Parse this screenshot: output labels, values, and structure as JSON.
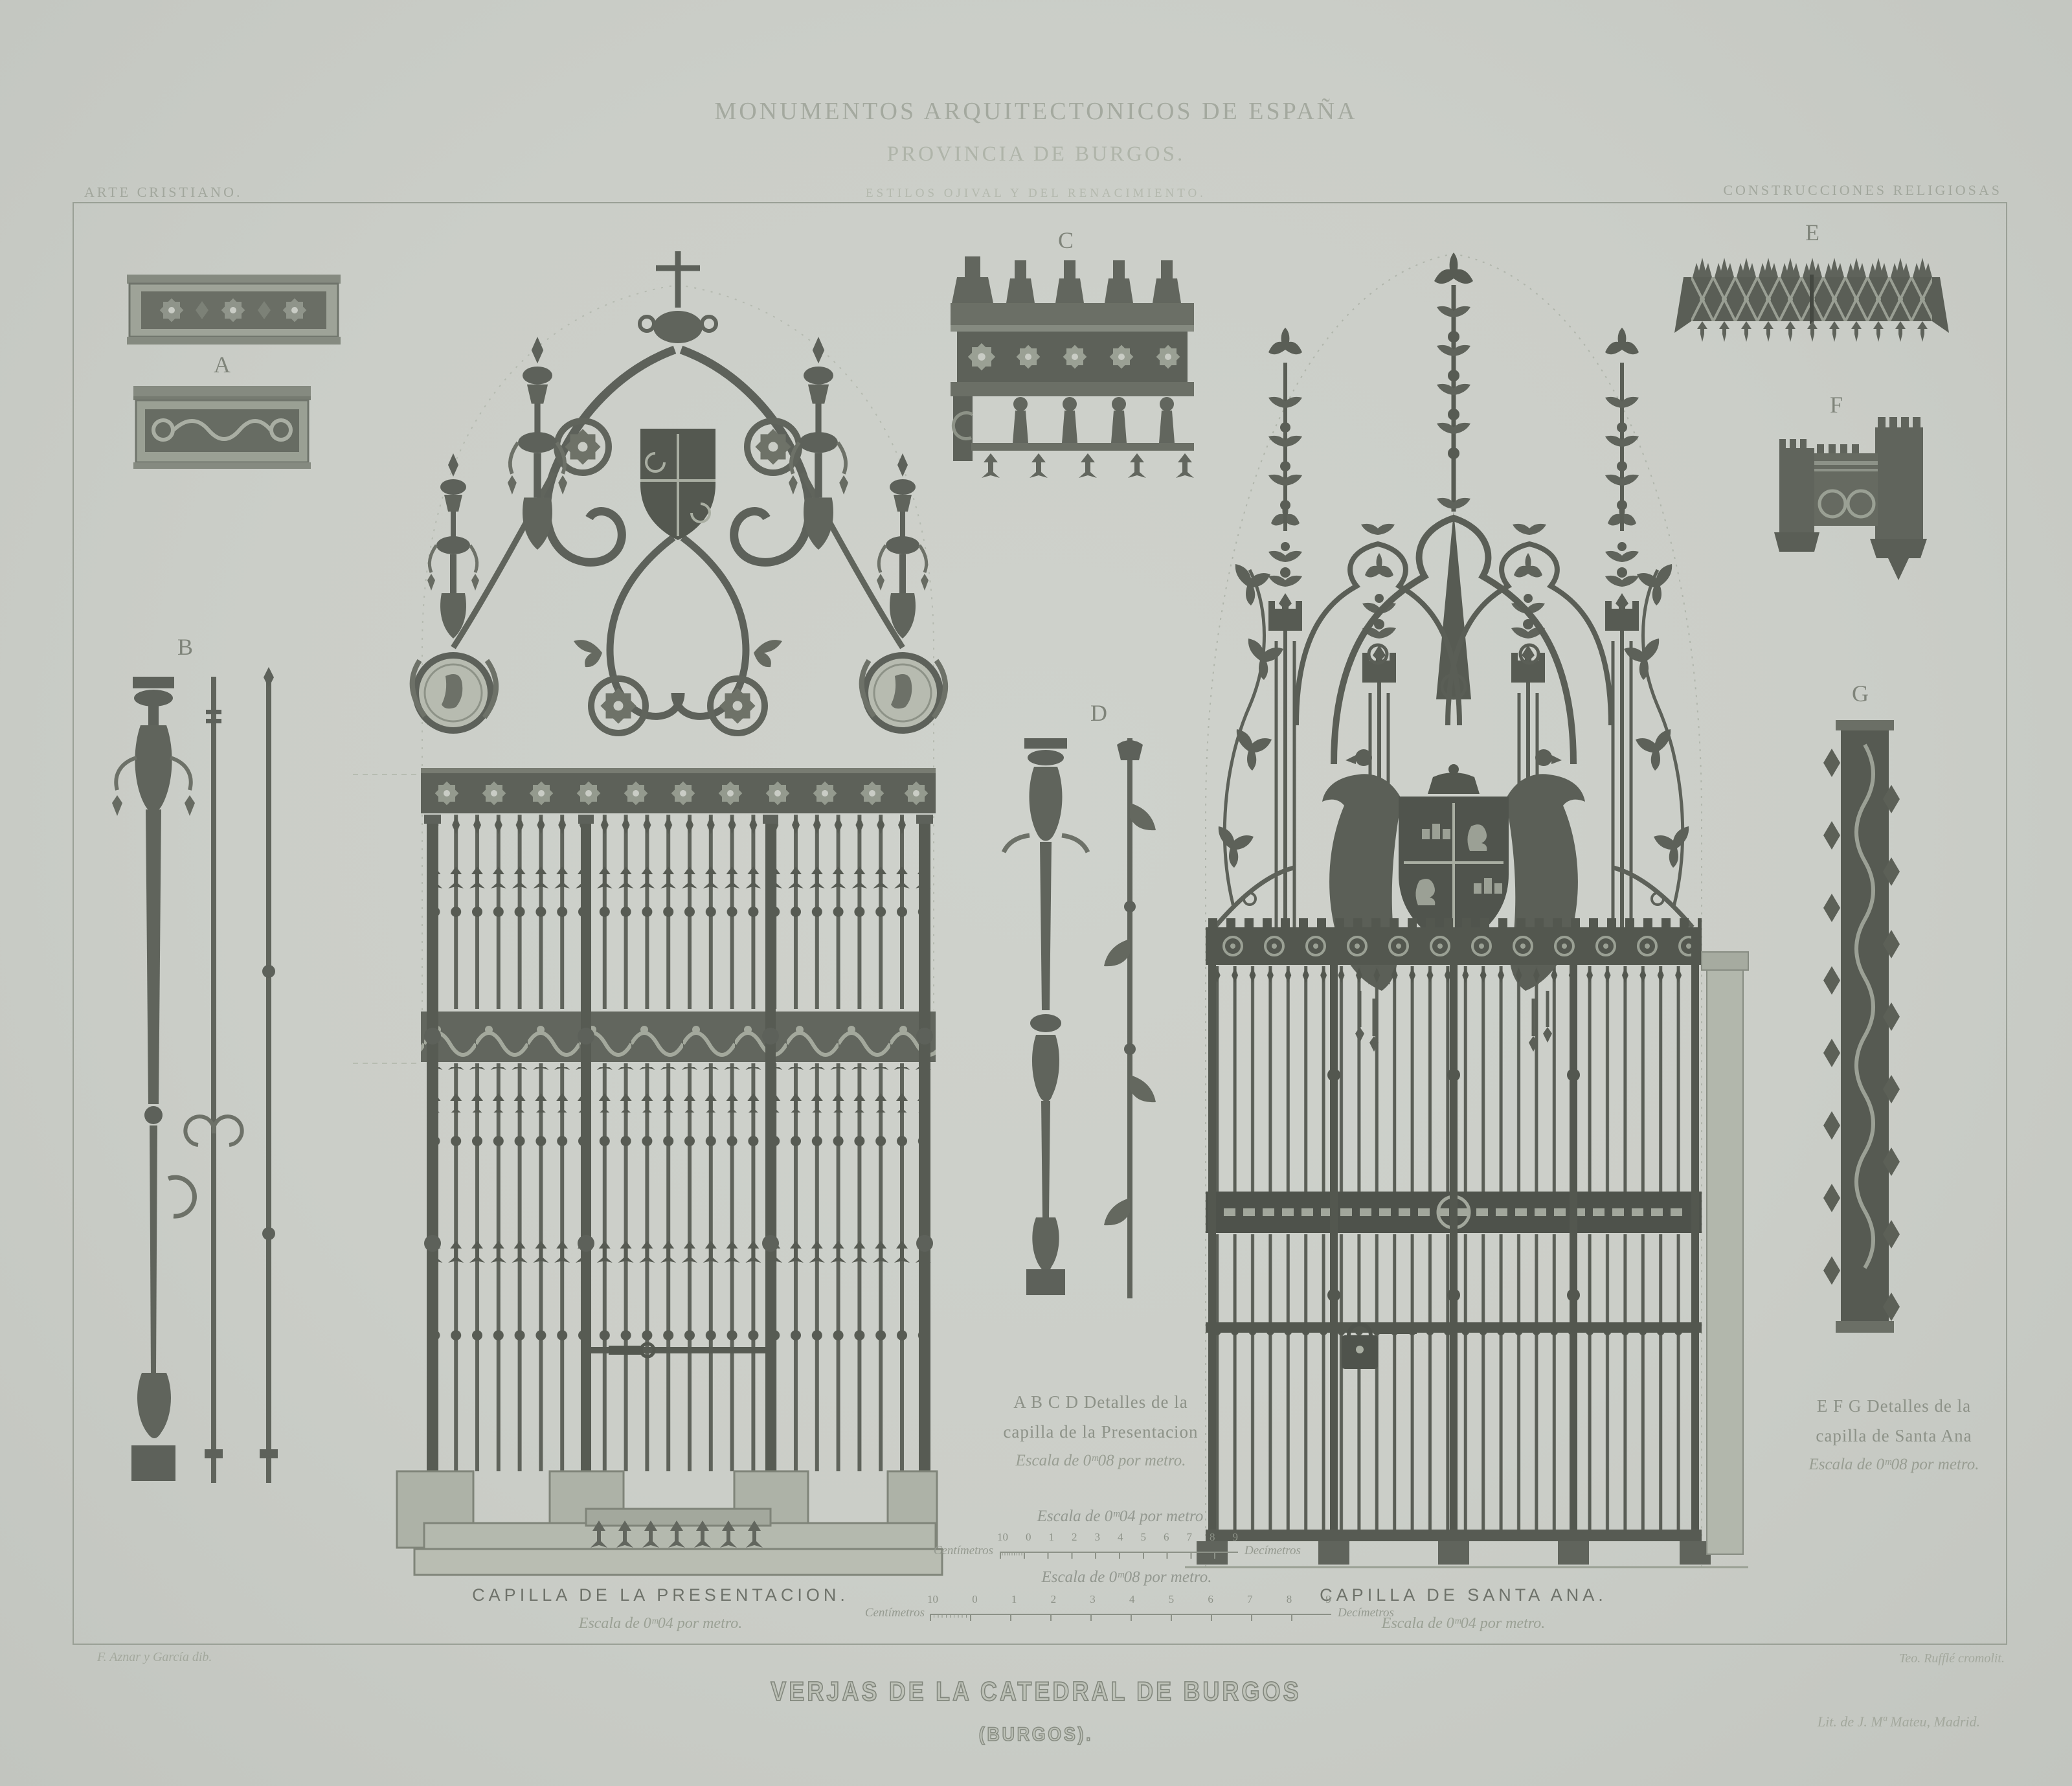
{
  "header": {
    "series_title": "MONUMENTOS ARQUITECTONICOS DE ESPAÑA",
    "province": "PROVINCIA DE BURGOS.",
    "styles_line": "ESTILOS OJIVAL Y DEL RENACIMIENTO.",
    "left_category": "ARTE CRISTIANO.",
    "right_category": "CONSTRUCCIONES RELIGIOSAS"
  },
  "figure_letters": {
    "a": "A",
    "b": "B",
    "c": "C",
    "d": "D",
    "e": "E",
    "f": "F",
    "g": "G"
  },
  "left_gate": {
    "caption": "CAPILLA DE LA PRESENTACION.",
    "scale_note": "Escala de 0ᵐ04 por metro."
  },
  "right_gate": {
    "caption": "CAPILLA DE SANTA ANA.",
    "scale_note": "Escala de 0ᵐ04 por metro."
  },
  "detail_notes": {
    "abcd": {
      "line1": "A B C D Detalles de la",
      "line2": "capilla de la Presentacion",
      "line3": "Escala de 0ᵐ08 por metro."
    },
    "efg": {
      "line1": "E F G Detalles de la",
      "line2": "capilla de Santa Ana",
      "line3": "Escala de 0ᵐ08 por metro."
    }
  },
  "scale_bars": {
    "small": {
      "title": "Escala de 0ᵐ04 por metro",
      "left_unit": "Centímetros",
      "right_unit": "Decímetros",
      "ticks": [
        "10",
        "0",
        "1",
        "2",
        "3",
        "4",
        "5",
        "6",
        "7",
        "8",
        "9"
      ]
    },
    "large": {
      "title": "Escala de 0ᵐ08 por metro.",
      "left_unit": "Centímetros",
      "right_unit": "Decímetros",
      "ticks": [
        "10",
        "0",
        "1",
        "2",
        "3",
        "4",
        "5",
        "6",
        "7",
        "8",
        "9"
      ]
    }
  },
  "footer": {
    "plate_title": "VERJAS DE LA CATEDRAL DE BURGOS",
    "plate_subtitle": "(BURGOS).",
    "credit_left": "F. Aznar y García dib.",
    "credit_right": "Teo. Rufflé cromolit.",
    "imprint": "Lit. de J. Mª Mateu, Madrid."
  },
  "palette": {
    "paper": "#cbcec8",
    "ink": "#565a54",
    "ink_light": "#8a8f86",
    "faint": "#a9aea4"
  }
}
